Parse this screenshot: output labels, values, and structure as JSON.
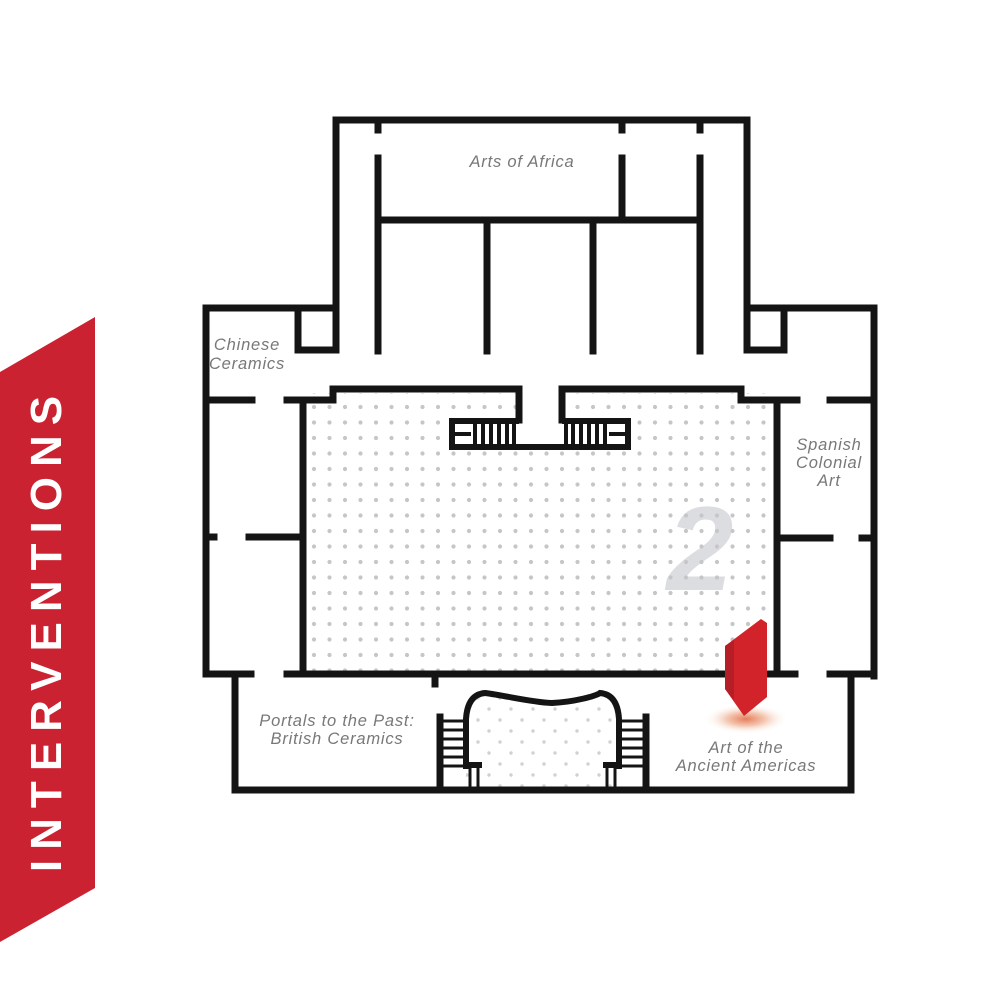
{
  "banner": {
    "label": "INTERVENTIONS",
    "background": "#cb2232",
    "text_color": "#ffffff"
  },
  "floor": {
    "number": "2",
    "color": "#dcdde0"
  },
  "rooms": {
    "africa": {
      "line1": "Arts of Africa"
    },
    "chinese": {
      "line1": "Chinese",
      "line2": "Ceramics"
    },
    "spanish": {
      "line1": "Spanish",
      "line2": "Colonial",
      "line3": "Art"
    },
    "portals": {
      "line1": "Portals to the Past:",
      "line2": "British Ceramics"
    },
    "americas": {
      "line1": "Art of the",
      "line2": "Ancient Americas"
    }
  },
  "marker": {
    "type": "you-are-here-pin",
    "color": "#d2232b",
    "shade_color": "#b51e26",
    "glow_color": "#dd5028"
  },
  "map_colors": {
    "wall": "#141414",
    "atrium_dot": "#c5c6c8",
    "theater_dot": "#d0d1d4",
    "label_text": "#77787a"
  }
}
